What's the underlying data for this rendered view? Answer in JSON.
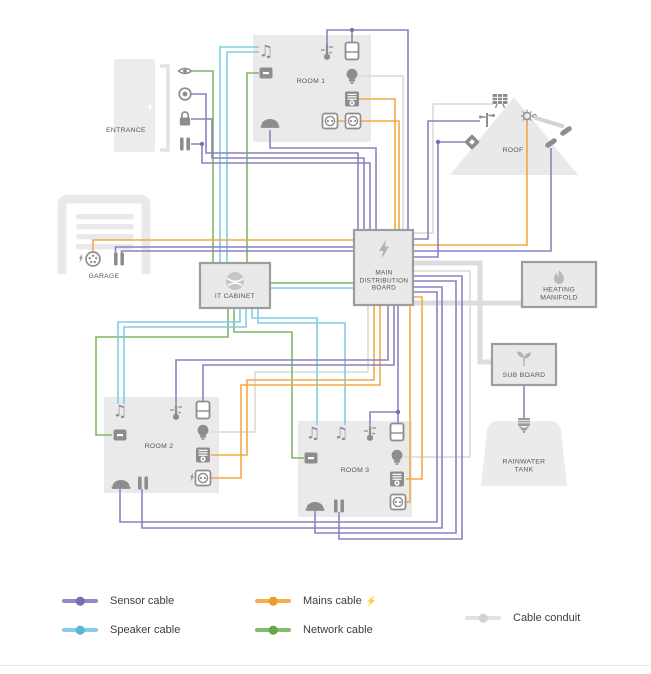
{
  "diagram": {
    "nodes": {
      "entrance": {
        "label": "ENTRANCE"
      },
      "room1": {
        "label": "ROOM 1"
      },
      "roof": {
        "label": "ROOF"
      },
      "garage": {
        "label": "GARAGE"
      },
      "it_cabinet": {
        "label": "IT CABINET"
      },
      "main_distribution_board": {
        "label": "MAIN DISTRIBUTION BOARD"
      },
      "heating_manifold": {
        "label": "HEATING MANIFOLD"
      },
      "sub_board": {
        "label": "SUB BOARD"
      },
      "rainwater_tank": {
        "label": "RAINWATER TANK"
      },
      "room2": {
        "label": "ROOM 2"
      },
      "room3": {
        "label": "ROOM 3"
      }
    },
    "cable_colors": {
      "sensor": "#8e81c0",
      "speaker": "#82cce8",
      "mains": "#f3a845",
      "network": "#7fb765",
      "conduit": "#dedede"
    },
    "icons": {
      "music_note_glyph": "♫"
    }
  },
  "legend": {
    "items": [
      {
        "id": "sensor",
        "label": "Sensor cable",
        "color": "#8e81c0"
      },
      {
        "id": "speaker",
        "label": "Speaker cable",
        "color": "#82cce8"
      },
      {
        "id": "mains",
        "label": "Mains cable",
        "color": "#f3a845"
      },
      {
        "id": "network",
        "label": "Network cable",
        "color": "#7fb765"
      },
      {
        "id": "conduit",
        "label": "Cable conduit",
        "color": "#dedede"
      }
    ],
    "mains_bolt_glyph": "⚡"
  }
}
